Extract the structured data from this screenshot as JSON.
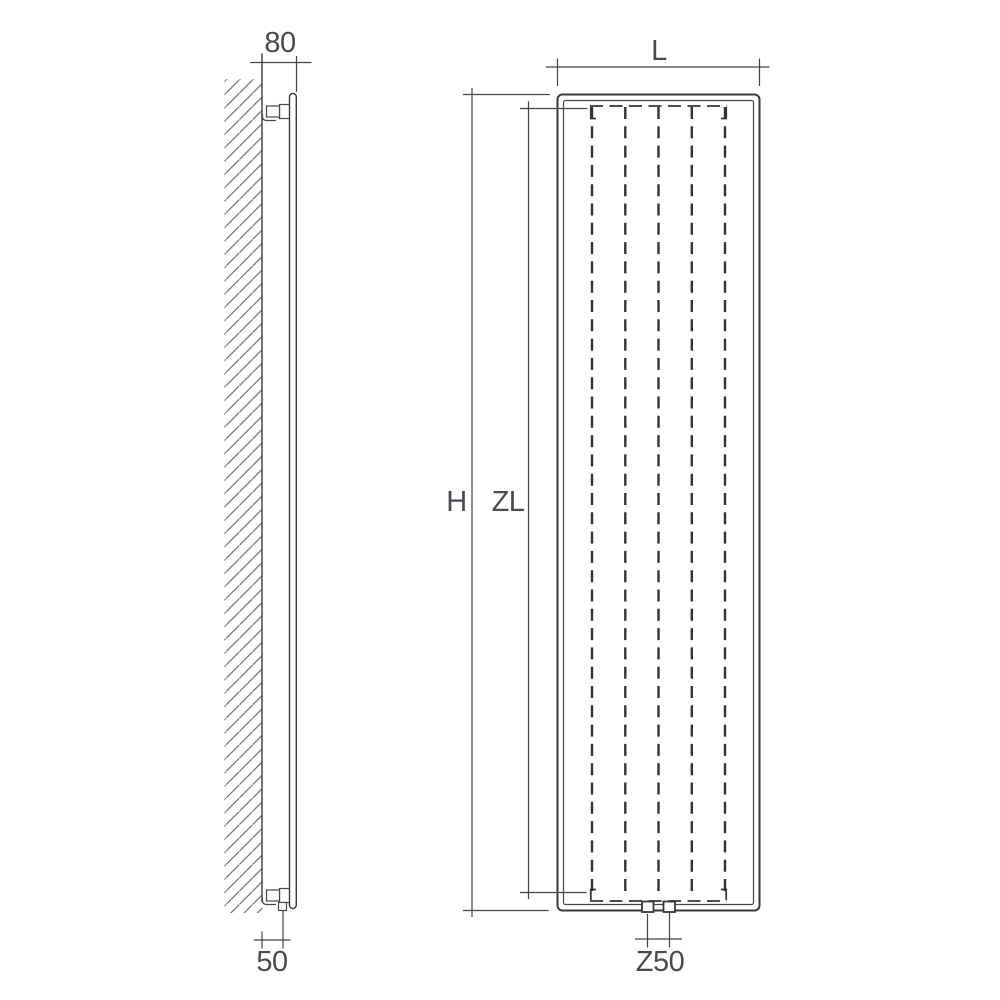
{
  "page": {
    "background": "#ffffff"
  },
  "style": {
    "line_color": "#3b3b3d",
    "text_color": "#4a4a50",
    "hatch_color": "#6b6b6e"
  },
  "figure": {
    "kind": "radiator-technical-dimension-drawing",
    "channel_count": 5
  },
  "labels": {
    "depth": "80",
    "wall_offset": "50",
    "width": "L",
    "height": "H",
    "connection_length": "ZL",
    "valve_spacing": "Z50"
  }
}
